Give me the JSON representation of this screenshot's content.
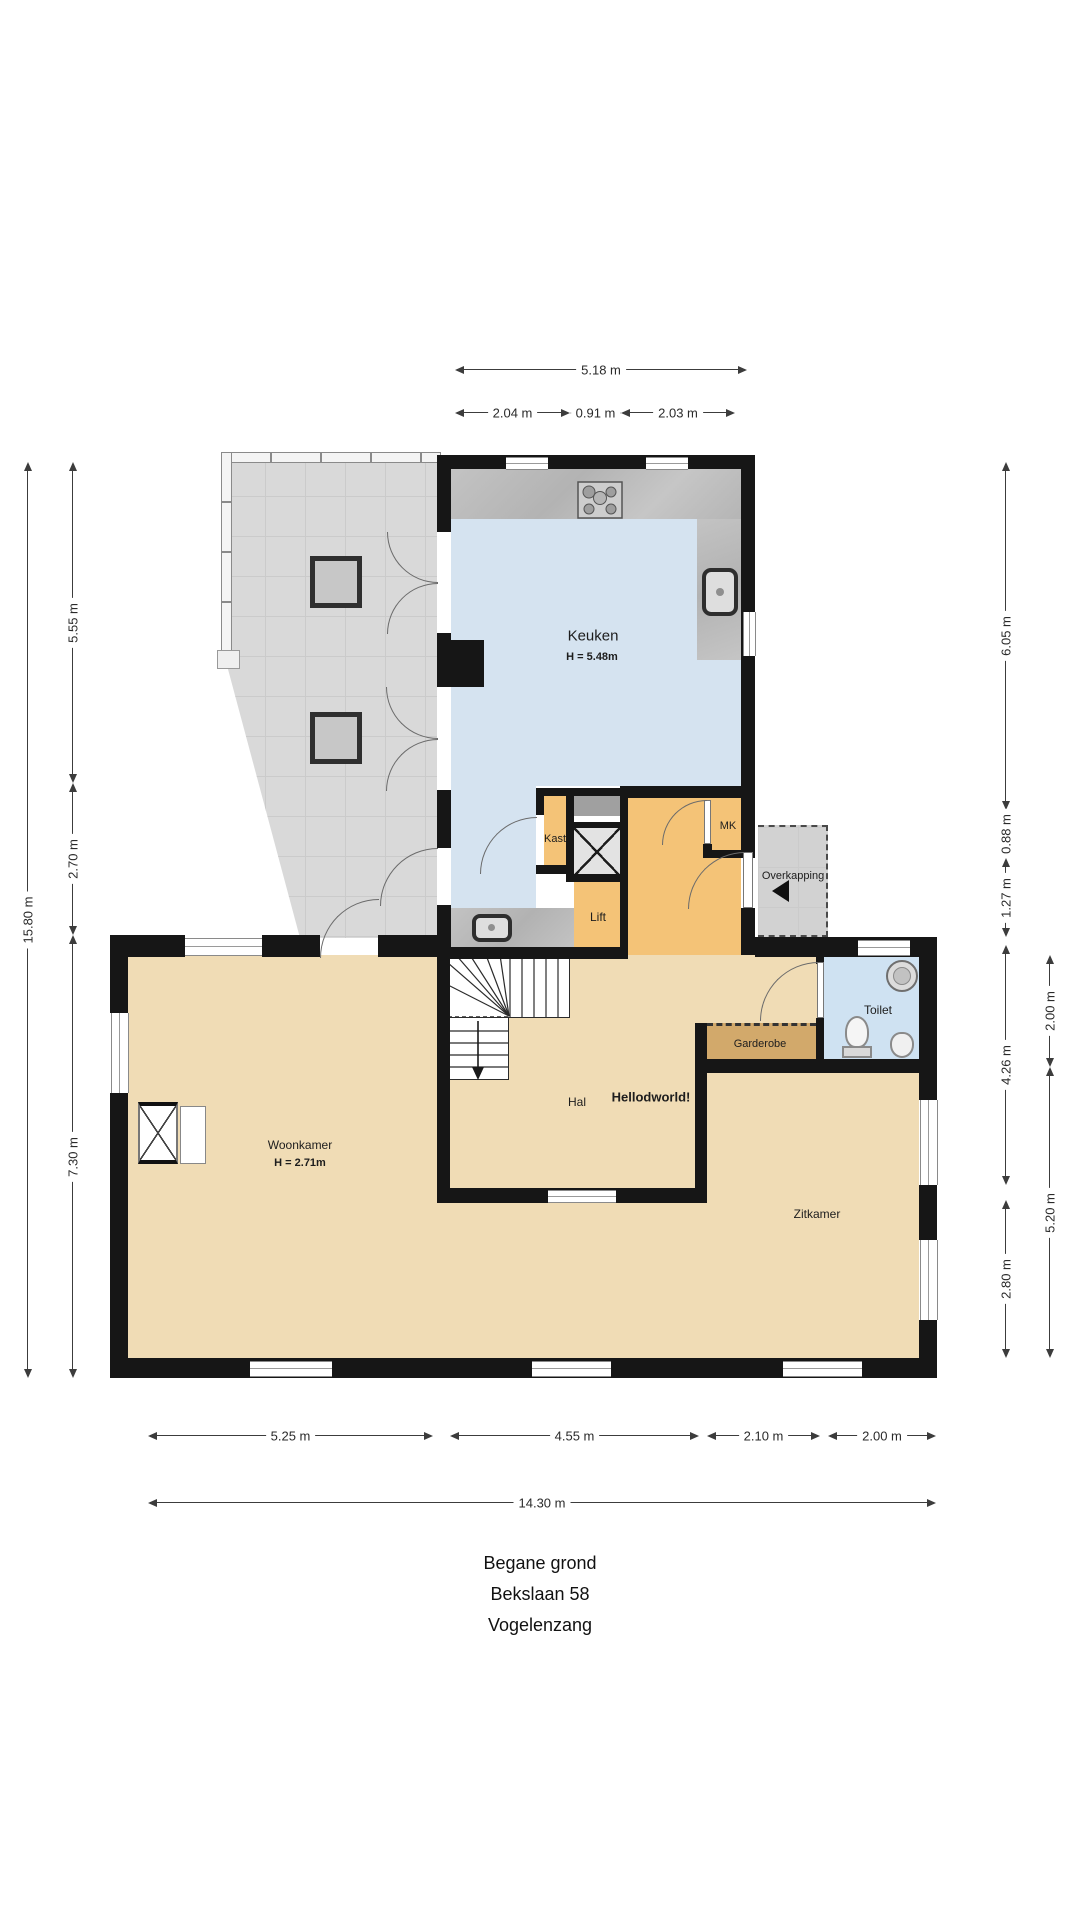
{
  "title": {
    "line1": "Begane grond",
    "line2": "Bekslaan 58",
    "line3": "Vogelenzang"
  },
  "rooms": {
    "keuken": {
      "label": "Keuken",
      "height": "H = 5.48m"
    },
    "kast": {
      "label": "Kast"
    },
    "lift": {
      "label": "Lift"
    },
    "mk": {
      "label": "MK"
    },
    "overkapping": {
      "label": "Overkapping"
    },
    "toilet": {
      "label": "Toilet"
    },
    "garderobe": {
      "label": "Garderobe"
    },
    "hal": {
      "label": "Hal"
    },
    "hal_note": {
      "label": "Hellodworld!"
    },
    "woonkamer": {
      "label": "Woonkamer",
      "height": "H = 2.71m"
    },
    "zitkamer": {
      "label": "Zitkamer"
    }
  },
  "dimensions": {
    "top_total": "5.18 m",
    "top_a": "2.04 m",
    "top_b": "0.91 m",
    "top_c": "2.03 m",
    "left_total": "15.80 m",
    "left_a": "5.55 m",
    "left_b": "2.70 m",
    "left_c": "7.30 m",
    "right_a": "6.05 m",
    "right_b": "0.88 m",
    "right_c": "1.27 m",
    "right_d": "4.26 m",
    "right_e": "2.80 m",
    "right_outer_a": "2.00 m",
    "right_outer_b": "5.20 m",
    "bottom_a": "5.25 m",
    "bottom_b": "4.55 m",
    "bottom_c": "2.10 m",
    "bottom_d": "2.00 m",
    "bottom_total": "14.30 m"
  },
  "colors": {
    "wall": "#161616",
    "kitchen_floor": "#d5e3f0",
    "toilet_floor": "#cfe2f2",
    "hall_floor": "#f4c377",
    "garderobe_floor": "#d2a96b",
    "living_floor": "#f0dcb5",
    "terrace_floor": "#d9d9d9",
    "counter": "#bdbdbd"
  }
}
